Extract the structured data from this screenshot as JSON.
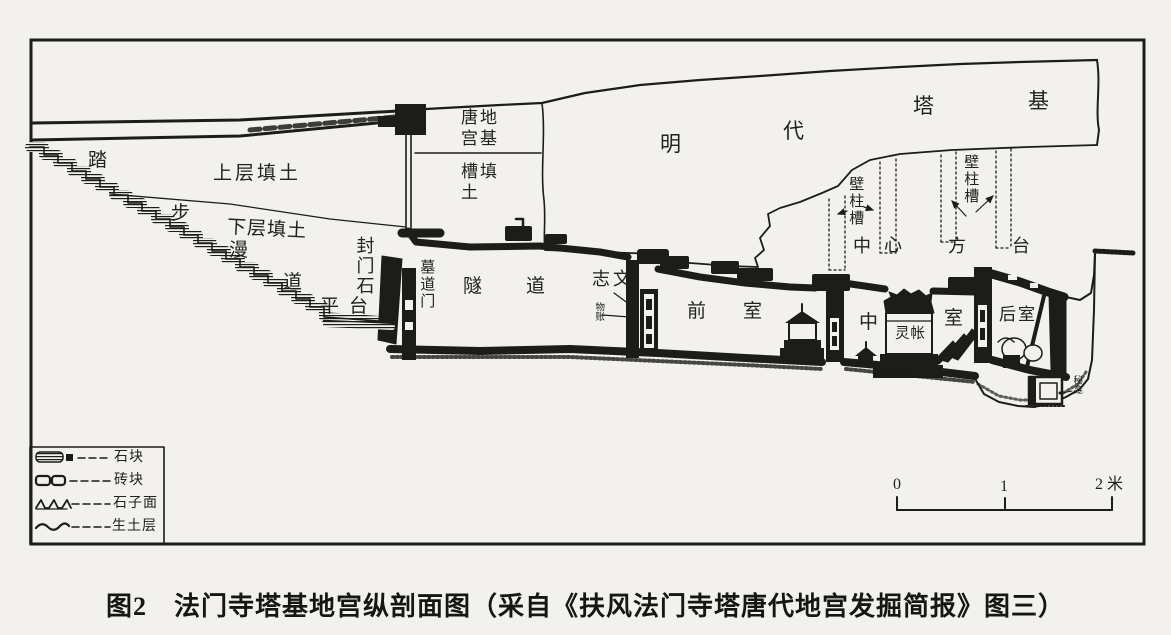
{
  "figure": {
    "caption": "图2　法门寺塔基地宫纵剖面图（采自《扶风法门寺塔唐代地宫发掘简报》图三）",
    "labels": {
      "ta": "踏",
      "bu": "步",
      "upper_fill": "上层填土",
      "lower_fill": "下层填土",
      "man": "漫",
      "dao": "道",
      "pingtai": "平台",
      "fengmenshi": "封门石",
      "mudaomen": "墓道门",
      "suidao": "隧道",
      "tang_base_line1": "唐地",
      "tang_base_line2": "宫基",
      "cao_fill_line1": "槽填",
      "cao_fill_line2": "土",
      "ming": "明",
      "dai": "代",
      "ta2": "塔",
      "ji": "基",
      "bizhucao_left": "壁柱槽",
      "zhong": "中",
      "xin": "心",
      "fang": "方",
      "tai": "台",
      "bizhucao_right": "壁柱槽",
      "zhiwen": "志文",
      "wuzhang": "物账",
      "qianshi": "前室",
      "zhongshi_zhong": "中",
      "zhongshi_shi": "室",
      "lingzhang": "灵帐",
      "houshi": "后室",
      "mikan": "秘龛"
    }
  },
  "legend": {
    "items": [
      {
        "symbol": "stone-block-symbol",
        "label": "石块"
      },
      {
        "symbol": "brick-symbol",
        "label": "砖块"
      },
      {
        "symbol": "gravel-surface-symbol",
        "label": "石子面"
      },
      {
        "symbol": "virgin-soil-symbol",
        "label": "生土层"
      }
    ]
  },
  "scale_bar": {
    "tick0": "0",
    "tick1": "1",
    "tick2": "2 米"
  },
  "colors": {
    "ink": "#1c1c1a",
    "paper": "#f2f1ee"
  }
}
